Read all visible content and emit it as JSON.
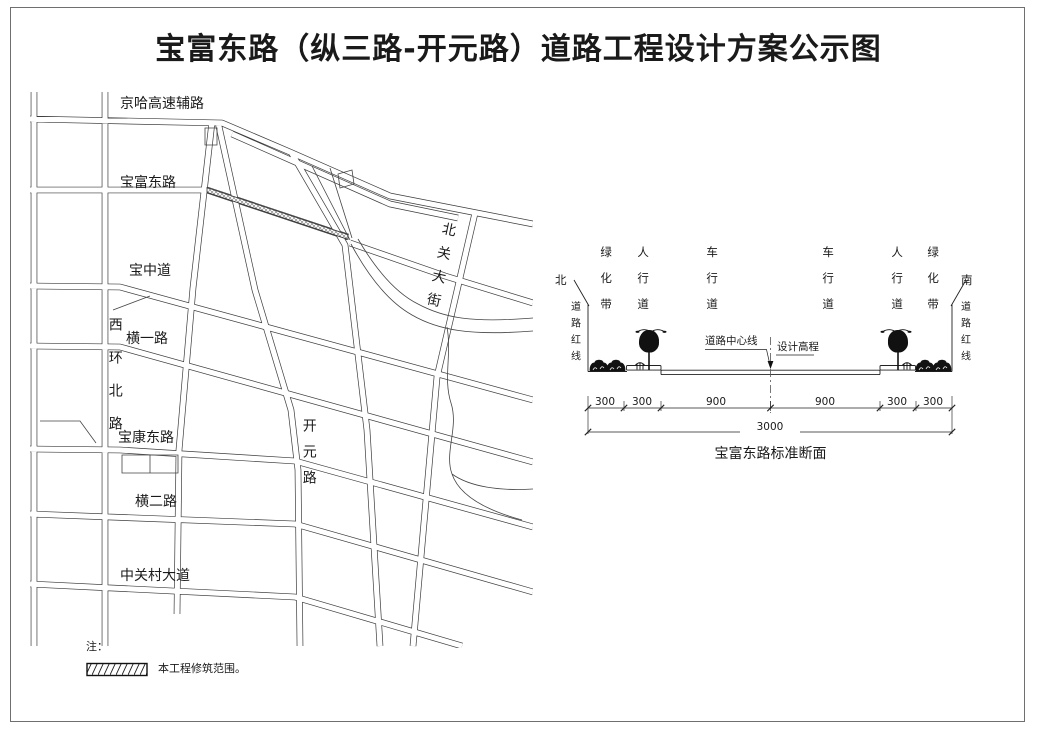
{
  "title": "宝富东路（纵三路-开元路）道路工程设计方案公示图",
  "map": {
    "road_labels": {
      "jingha_expressway_side_road": "京哈高速辅路",
      "baofu_east_road": "宝富东路",
      "baozhong_road": "宝中道",
      "heng_yi_road": "横一路",
      "xihuan_north_road": "西环北路",
      "baokang_east_road": "宝康东路",
      "heng_er_road": "横二路",
      "zhongguancun_avenue": "中关村大道",
      "kaiyuan_road": "开元路",
      "beiguan_street": "北关大街"
    }
  },
  "section": {
    "north_label": "北",
    "south_label": "南",
    "red_line_label": "道路红线",
    "lanes": [
      "绿化带",
      "人行道",
      "车行道",
      "车行道",
      "人行道",
      "绿化带"
    ],
    "centerline_label": "道路中心线",
    "design_elevation_label": "设计高程",
    "dims": [
      "300",
      "300",
      "900",
      "900",
      "300",
      "300"
    ],
    "total_dim": "3000",
    "caption": "宝富东路标准断面"
  },
  "note": {
    "prefix": "注：",
    "legend_text": "本工程修筑范围。"
  },
  "colors": {
    "line": "#3c3c3c",
    "frame": "#6f6f6f",
    "hatch": "#777777"
  }
}
